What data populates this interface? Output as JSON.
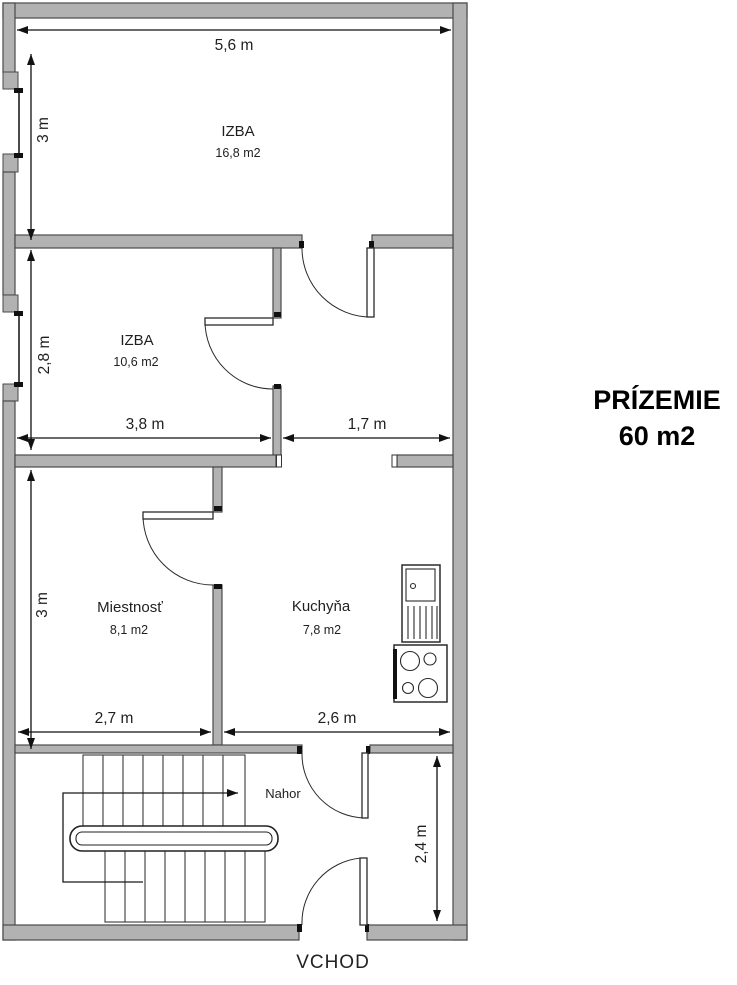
{
  "floor": {
    "name": "PRÍZEMIE",
    "area": "60 m2"
  },
  "rooms": [
    {
      "name": "IZBA",
      "area": "16,8 m2"
    },
    {
      "name": "IZBA",
      "area": "10,6 m2"
    },
    {
      "name": "Miestnosť",
      "area": "8,1 m2"
    },
    {
      "name": "Kuchyňa",
      "area": "7,8 m2"
    }
  ],
  "dimensions": {
    "room1_width": "5,6 m",
    "room1_height": "3 m",
    "room2_width": "3,8 m",
    "room2_height": "2,8 m",
    "hallway_width": "1,7 m",
    "room3_width": "2,7 m",
    "room3_height": "3 m",
    "kitchen_width": "2,6 m",
    "entry_height": "2,4 m"
  },
  "annotations": {
    "stairs_up": "Nahor",
    "entrance": "VCHOD"
  },
  "icons": {
    "doors": "door-swing-icon",
    "windows": "window-icon",
    "stairs": "staircase-icon",
    "sink": "kitchen-sink-icon",
    "stove": "stove-icon",
    "walk_arrow": "up-direction-arrow"
  },
  "colors": {
    "wall_fill": "#b2b2b2",
    "wall_outline": "#4a4a4a",
    "line": "#1a1a1a",
    "text": "#1f1f1f",
    "background": "#ffffff"
  }
}
